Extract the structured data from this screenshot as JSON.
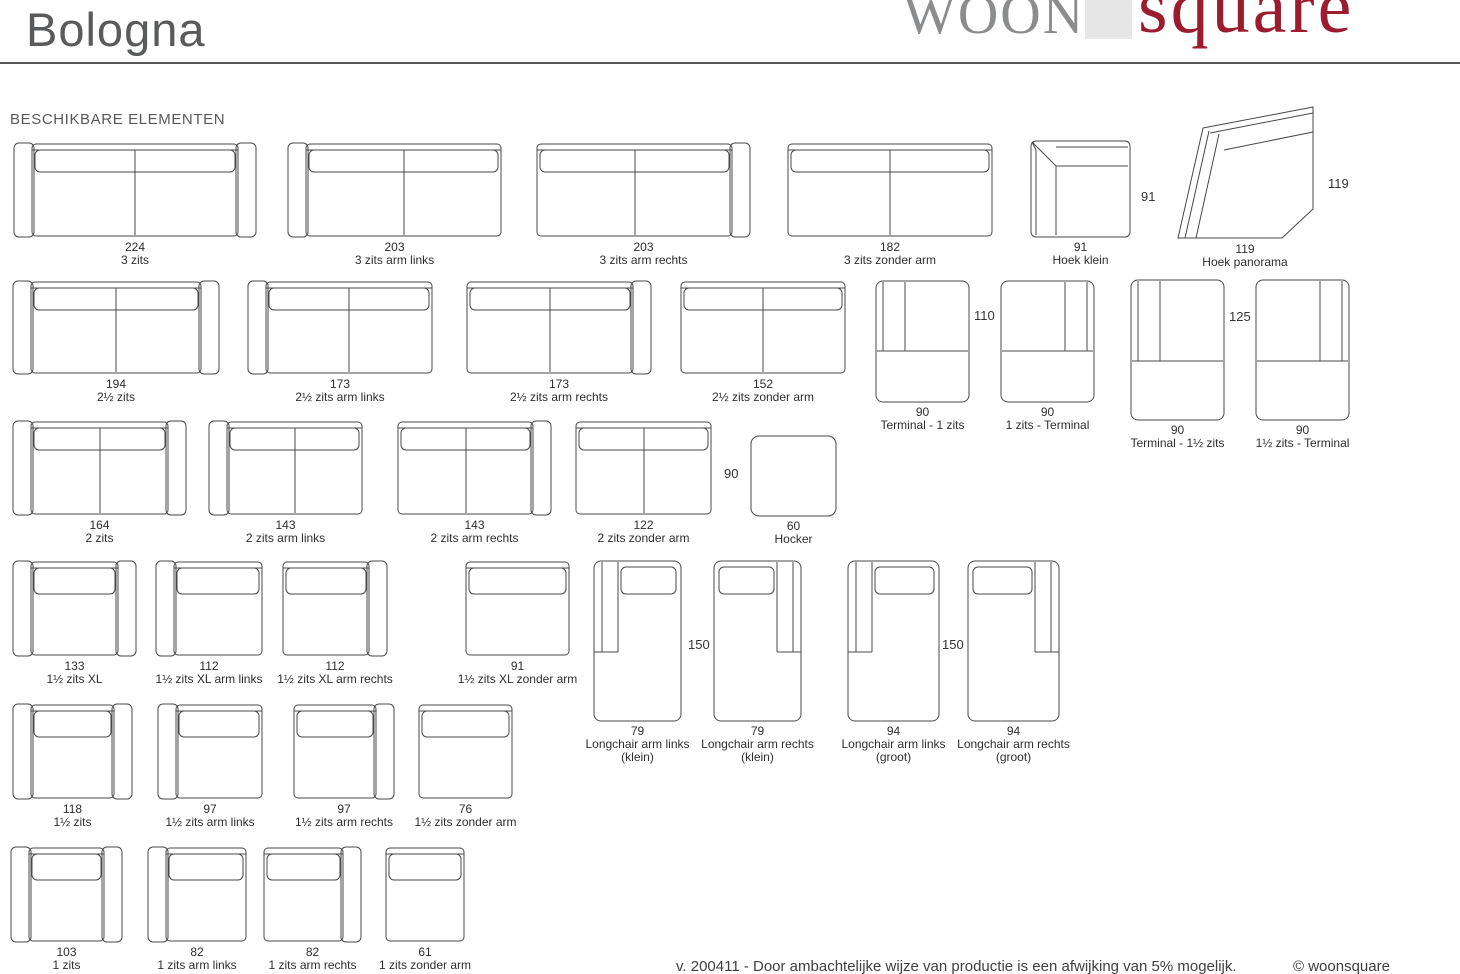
{
  "page": {
    "width": 1460,
    "height": 974,
    "background": "#ffffff"
  },
  "header": {
    "title": "Bologna"
  },
  "logo": {
    "woon": "WOON",
    "square_text": "square",
    "woon_color": "#8b8c8e",
    "square_color": "#9b1b2f",
    "box_color": "#e7e7e8"
  },
  "section": {
    "heading": "BESCHIKBARE ELEMENTEN"
  },
  "colors": {
    "stroke": "#48484a",
    "label": "#2e2e2e",
    "dim": "#343434",
    "title": "#595a5c",
    "rule": "#58585a",
    "footer": "#3f3f41"
  },
  "footer": {
    "note": "v. 200411 - Door ambachtelijke wijze van productie is een afwijking van 5% mogelijk.",
    "copyright": "© woonsquare"
  },
  "clipped_left_dimensions": [
    {
      "text": "4",
      "x": -9,
      "y": 181
    },
    {
      "text": "4",
      "x": -9,
      "y": 320
    },
    {
      "text": "4",
      "x": -9,
      "y": 461
    }
  ],
  "elements": [
    {
      "name": "3-zits",
      "shape": "sofa",
      "arms": "both",
      "pillows": 2,
      "x": 13,
      "y": 142,
      "w": 244,
      "h": 96,
      "size": "224",
      "label": "3 zits"
    },
    {
      "name": "3-zits-arm-links",
      "shape": "sofa",
      "arms": "left",
      "pillows": 2,
      "x": 287,
      "y": 142,
      "w": 215,
      "h": 96,
      "size": "203",
      "label": "3 zits arm links"
    },
    {
      "name": "3-zits-arm-rechts",
      "shape": "sofa",
      "arms": "right",
      "pillows": 2,
      "x": 536,
      "y": 142,
      "w": 215,
      "h": 96,
      "size": "203",
      "label": "3 zits arm rechts"
    },
    {
      "name": "3-zits-zonder-arm",
      "shape": "sofa",
      "arms": "none",
      "pillows": 2,
      "x": 787,
      "y": 142,
      "w": 206,
      "h": 96,
      "size": "182",
      "label": "3 zits zonder arm"
    },
    {
      "name": "hoek-klein",
      "shape": "hoek-klein",
      "x": 1030,
      "y": 140,
      "w": 101,
      "h": 98,
      "size": "91",
      "label": "Hoek klein",
      "dim": {
        "text": "91",
        "x": 1141,
        "y": 189
      }
    },
    {
      "name": "hoek-panorama",
      "shape": "hoek-panorama",
      "x": 1176,
      "y": 104,
      "w": 138,
      "h": 136,
      "size": "119",
      "label": "Hoek panorama",
      "dim": {
        "text": "119",
        "x": 1328,
        "y": 176
      }
    },
    {
      "name": "2half-zits",
      "shape": "sofa",
      "arms": "both",
      "pillows": 2,
      "x": 12,
      "y": 280,
      "w": 208,
      "h": 95,
      "size": "194",
      "label": "2½ zits"
    },
    {
      "name": "2half-zits-arm-links",
      "shape": "sofa",
      "arms": "left",
      "pillows": 2,
      "x": 247,
      "y": 280,
      "w": 186,
      "h": 95,
      "size": "173",
      "label": "2½ zits arm links"
    },
    {
      "name": "2half-zits-arm-rechts",
      "shape": "sofa",
      "arms": "right",
      "pillows": 2,
      "x": 466,
      "y": 280,
      "w": 186,
      "h": 95,
      "size": "173",
      "label": "2½ zits arm rechts"
    },
    {
      "name": "2half-zits-zonder-arm",
      "shape": "sofa",
      "arms": "none",
      "pillows": 2,
      "x": 680,
      "y": 280,
      "w": 166,
      "h": 95,
      "size": "152",
      "label": "2½ zits zonder arm"
    },
    {
      "name": "terminal-1-zits",
      "shape": "terminal",
      "arms": "left",
      "x": 875,
      "y": 280,
      "w": 95,
      "h": 123,
      "size": "90",
      "label": "Terminal - 1 zits",
      "dim": {
        "text": "110",
        "x": 974,
        "y": 308
      }
    },
    {
      "name": "1-zits-terminal",
      "shape": "terminal",
      "arms": "right",
      "x": 1000,
      "y": 280,
      "w": 95,
      "h": 123,
      "size": "90",
      "label": "1 zits - Terminal"
    },
    {
      "name": "terminal-1half-zits",
      "shape": "terminal",
      "arms": "left",
      "x": 1130,
      "y": 279,
      "w": 95,
      "h": 142,
      "size": "90",
      "label": "Terminal - 1½ zits",
      "dim": {
        "text": "125",
        "x": 1229,
        "y": 309
      }
    },
    {
      "name": "1half-zits-terminal",
      "shape": "terminal",
      "arms": "right",
      "x": 1255,
      "y": 279,
      "w": 95,
      "h": 142,
      "size": "90",
      "label": "1½ zits - Terminal"
    },
    {
      "name": "2-zits",
      "shape": "sofa",
      "arms": "both",
      "pillows": 2,
      "x": 12,
      "y": 420,
      "w": 175,
      "h": 96,
      "size": "164",
      "label": "2 zits"
    },
    {
      "name": "2-zits-arm-links",
      "shape": "sofa",
      "arms": "left",
      "pillows": 2,
      "x": 208,
      "y": 420,
      "w": 155,
      "h": 96,
      "size": "143",
      "label": "2 zits arm links"
    },
    {
      "name": "2-zits-arm-rechts",
      "shape": "sofa",
      "arms": "right",
      "pillows": 2,
      "x": 397,
      "y": 420,
      "w": 155,
      "h": 96,
      "size": "143",
      "label": "2 zits arm rechts"
    },
    {
      "name": "2-zits-zonder-arm",
      "shape": "sofa",
      "arms": "none",
      "pillows": 2,
      "x": 575,
      "y": 420,
      "w": 137,
      "h": 96,
      "size": "122",
      "label": "2 zits zonder arm"
    },
    {
      "name": "hocker",
      "shape": "hocker",
      "x": 750,
      "y": 435,
      "w": 87,
      "h": 82,
      "size": "60",
      "label": "Hocker",
      "dim": {
        "text": "90",
        "x": 724,
        "y": 466
      }
    },
    {
      "name": "1half-zits-xl",
      "shape": "sofa",
      "arms": "both",
      "pillows": 1,
      "x": 12,
      "y": 560,
      "w": 125,
      "h": 97,
      "size": "133",
      "label": "1½ zits XL"
    },
    {
      "name": "1half-zits-xl-arm-links",
      "shape": "sofa",
      "arms": "left",
      "pillows": 1,
      "x": 155,
      "y": 560,
      "w": 108,
      "h": 97,
      "size": "112",
      "label": "1½ zits XL arm links"
    },
    {
      "name": "1half-zits-xl-arm-rechts",
      "shape": "sofa",
      "arms": "right",
      "pillows": 1,
      "x": 282,
      "y": 560,
      "w": 106,
      "h": 97,
      "size": "112",
      "label": "1½ zits XL arm rechts"
    },
    {
      "name": "1half-zits-xl-zonder-arm",
      "shape": "sofa",
      "arms": "none",
      "pillows": 1,
      "x": 465,
      "y": 560,
      "w": 105,
      "h": 97,
      "size": "91",
      "label": "1½ zits XL zonder arm"
    },
    {
      "name": "longchair-arm-links-klein",
      "shape": "longchair",
      "arms": "left",
      "x": 593,
      "y": 560,
      "w": 89,
      "h": 162,
      "size": "79",
      "label": "Longchair arm links",
      "sub": "(klein)",
      "dim": {
        "text": "150",
        "x": 688,
        "y": 637
      }
    },
    {
      "name": "longchair-arm-rechts-klein",
      "shape": "longchair",
      "arms": "right",
      "x": 713,
      "y": 560,
      "w": 89,
      "h": 162,
      "size": "79",
      "label": "Longchair arm rechts",
      "sub": "(klein)"
    },
    {
      "name": "longchair-arm-links-groot",
      "shape": "longchair",
      "arms": "left",
      "x": 847,
      "y": 560,
      "w": 93,
      "h": 162,
      "size": "94",
      "label": "Longchair arm links",
      "sub": "(groot)",
      "dim": {
        "text": "150",
        "x": 942,
        "y": 637
      }
    },
    {
      "name": "longchair-arm-rechts-groot",
      "shape": "longchair",
      "arms": "right",
      "x": 967,
      "y": 560,
      "w": 93,
      "h": 162,
      "size": "94",
      "label": "Longchair arm rechts",
      "sub": "(groot)"
    },
    {
      "name": "1half-zits",
      "shape": "sofa",
      "arms": "both",
      "pillows": 1,
      "x": 12,
      "y": 703,
      "w": 121,
      "h": 97,
      "size": "118",
      "label": "1½ zits"
    },
    {
      "name": "1half-zits-arm-links",
      "shape": "sofa",
      "arms": "left",
      "pillows": 1,
      "x": 157,
      "y": 703,
      "w": 106,
      "h": 97,
      "size": "97",
      "label": "1½ zits arm links"
    },
    {
      "name": "1half-zits-arm-rechts",
      "shape": "sofa",
      "arms": "right",
      "pillows": 1,
      "x": 293,
      "y": 703,
      "w": 102,
      "h": 97,
      "size": "97",
      "label": "1½ zits arm rechts"
    },
    {
      "name": "1half-zits-zonder-arm",
      "shape": "sofa",
      "arms": "none",
      "pillows": 1,
      "x": 418,
      "y": 703,
      "w": 95,
      "h": 97,
      "size": "76",
      "label": "1½ zits zonder arm"
    },
    {
      "name": "1-zits",
      "shape": "sofa",
      "arms": "both",
      "pillows": 1,
      "x": 10,
      "y": 846,
      "w": 113,
      "h": 97,
      "size": "103",
      "label": "1 zits"
    },
    {
      "name": "1-zits-arm-links",
      "shape": "sofa",
      "arms": "left",
      "pillows": 1,
      "x": 147,
      "y": 846,
      "w": 100,
      "h": 97,
      "size": "82",
      "label": "1 zits arm links"
    },
    {
      "name": "1-zits-arm-rechts",
      "shape": "sofa",
      "arms": "right",
      "pillows": 1,
      "x": 263,
      "y": 846,
      "w": 99,
      "h": 97,
      "size": "82",
      "label": "1 zits arm rechts"
    },
    {
      "name": "1-zits-zonder-arm",
      "shape": "sofa",
      "arms": "none",
      "pillows": 1,
      "x": 385,
      "y": 846,
      "w": 80,
      "h": 97,
      "size": "61",
      "label": "1 zits zonder arm"
    }
  ]
}
